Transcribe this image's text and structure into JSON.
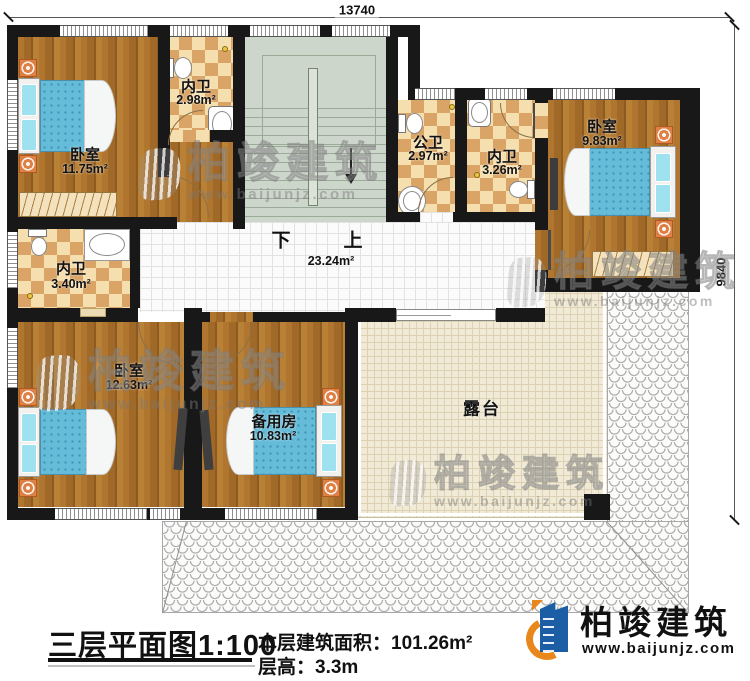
{
  "dimensions": {
    "top": "13740",
    "right": "9840"
  },
  "stairs": {
    "down": "下",
    "up": "上",
    "hall_area": "23.24m²"
  },
  "rooms": {
    "bedroom_tl": {
      "name": "卧室",
      "area": "11.75m²"
    },
    "ensuite_tl": {
      "name": "内卫",
      "area": "2.98m²"
    },
    "public_bath": {
      "name": "公卫",
      "area": "2.97m²"
    },
    "ensuite_tr": {
      "name": "内卫",
      "area": "3.26m²"
    },
    "bedroom_tr": {
      "name": "卧室",
      "area": "9.83m²"
    },
    "ensuite_ml": {
      "name": "内卫",
      "area": "3.40m²"
    },
    "bedroom_bl": {
      "name": "卧室",
      "area": "12.63m²"
    },
    "spare_room": {
      "name": "备用房",
      "area": "10.83m²"
    },
    "terrace": {
      "name": "露台"
    }
  },
  "footer": {
    "title": "三层平面图1:100",
    "area_label": "本层建筑面积：",
    "area_value": "101.26m²",
    "height_label": "层高：",
    "height_value": "3.3m"
  },
  "logo": {
    "company": "柏竣建筑",
    "website": "www.baijunjz.com"
  },
  "watermark": {
    "brand": "柏竣建筑",
    "website": "www.baijunjz.com"
  },
  "colors": {
    "wall": "#181818",
    "wood": "#aa6f2c",
    "bath_light": "#f6dfae",
    "bath_dark": "#d9a465",
    "stair": "#cdd6cb",
    "terrace": "#f1ead6",
    "logo_blue": "#1b5ea6",
    "logo_orange": "#e8881c"
  }
}
